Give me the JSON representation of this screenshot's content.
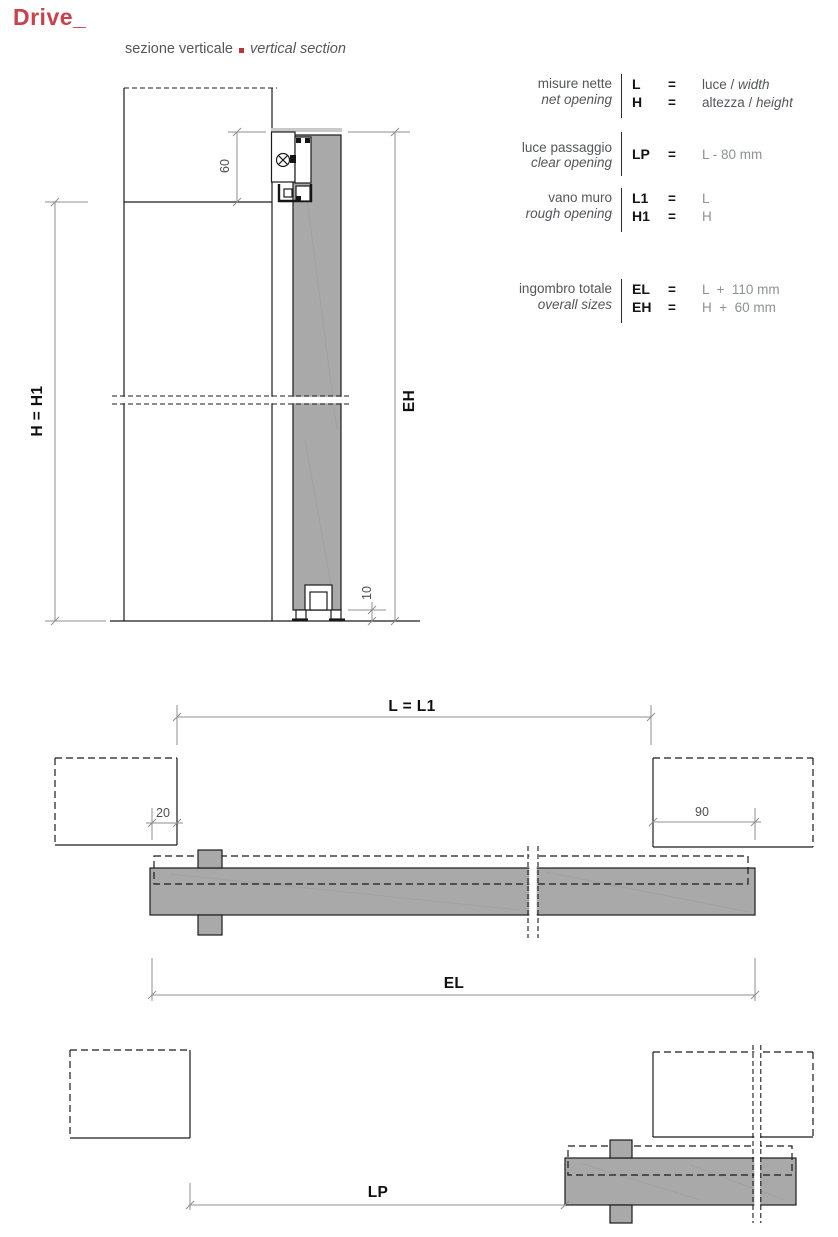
{
  "page": {
    "title": "Drive_",
    "subtitle_it": "sezione verticale",
    "subtitle_en": "vertical section"
  },
  "colors": {
    "accent_red": "#c8414b",
    "bullet_red": "#b5373d",
    "door_gray": "#a9a9a9",
    "text_gray": "#55565a",
    "muted_value_gray": "#8e9194"
  },
  "spec_table": {
    "rows": [
      {
        "label_it": "misure nette",
        "label_en": "net opening",
        "entries": [
          {
            "sym": "L",
            "eq": "=",
            "val": "luce / ",
            "val_italic": "width"
          },
          {
            "sym": "H",
            "eq": "=",
            "val": "altezza / ",
            "val_italic": "height"
          }
        ]
      },
      {
        "label_it": "luce passaggio",
        "label_en": "clear opening",
        "entries": [
          {
            "sym": "LP",
            "eq": "=",
            "val_muted": "L - 80 mm"
          }
        ]
      },
      {
        "label_it": "vano muro",
        "label_en": "rough opening",
        "entries": [
          {
            "sym": "L1",
            "eq": "=",
            "val_muted": "L"
          },
          {
            "sym": "H1",
            "eq": "=",
            "val_muted": "H"
          }
        ]
      },
      {
        "label_it": "ingombro totale",
        "label_en": "overall sizes",
        "entries": [
          {
            "sym": "EL",
            "eq": "=",
            "val_muted": "L  +  110 mm"
          },
          {
            "sym": "EH",
            "eq": "=",
            "val_muted": "H  +  60 mm"
          }
        ]
      }
    ]
  },
  "drawings": {
    "vertical_section": {
      "dim_top": "60",
      "dim_floor_gap": "10",
      "dim_height": "H = H1",
      "dim_overall_height": "EH"
    },
    "plan_closed": {
      "dim_width": "L = L1",
      "dim_overlap": "20",
      "dim_pocket": "90",
      "dim_overall_width": "EL"
    },
    "plan_open": {
      "dim_clear": "LP"
    }
  }
}
